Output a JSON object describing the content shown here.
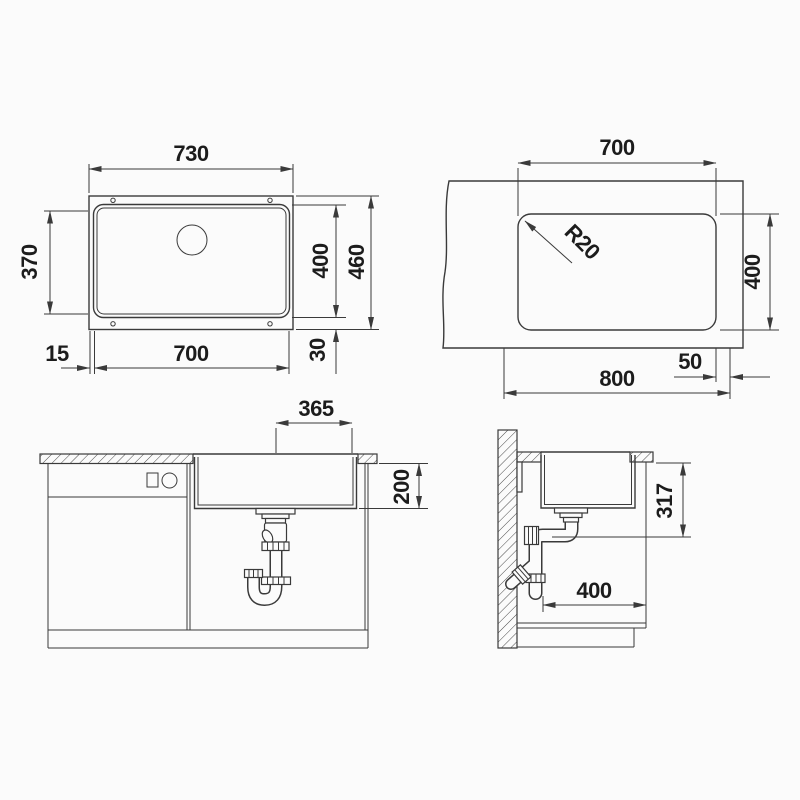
{
  "drawing": {
    "type": "sink-installation-technical-drawing",
    "units": "mm",
    "colors": {
      "line": "#3a3a3a",
      "text": "#1c1c1c",
      "background": "#fbfbfb"
    },
    "views": {
      "sink_top": {
        "overall_width": "730",
        "left_depth": "370",
        "bowl_depth": "400",
        "overall_depth": "460",
        "rim_offset": "15",
        "bowl_width": "700",
        "bottom_offset": "30"
      },
      "cutout_top": {
        "cutout_width": "700",
        "corner_radius": "R20",
        "cutout_depth": "400",
        "edge_distance": "50",
        "min_cabinet_width": "800"
      },
      "front_elevation": {
        "drain_to_cutout_edge": "365",
        "bowl_inner_depth": "200"
      },
      "side_section": {
        "installation_height": "317",
        "bowl_front_to_back": "400"
      }
    }
  }
}
